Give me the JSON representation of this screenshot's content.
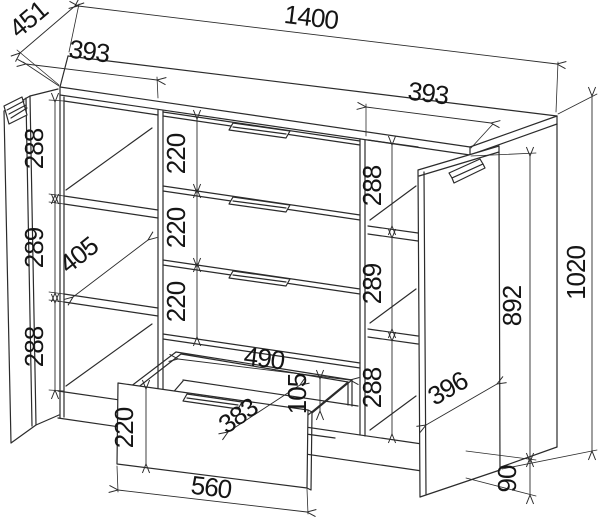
{
  "dimensions": {
    "total_width": "1400",
    "top_depth": "451",
    "left_section_width": "393",
    "right_section_width": "393",
    "left_shelf_heights": [
      "288",
      "289",
      "288"
    ],
    "shelf_depth": "405",
    "drawer_heights": [
      "220",
      "220",
      "220"
    ],
    "opening_width": "490",
    "drawer_box_depth": "383",
    "drawer_box_height": "105",
    "drawer_front_width": "560",
    "drawer_front_height": "220",
    "right_shelf_heights": [
      "288",
      "289",
      "288"
    ],
    "door_width": "396",
    "cabinet_body_height": "892",
    "total_height": "1020",
    "plinth_height": "90"
  },
  "colors": {
    "line": "#2b2b2b",
    "text": "#151515",
    "background": "#ffffff"
  }
}
